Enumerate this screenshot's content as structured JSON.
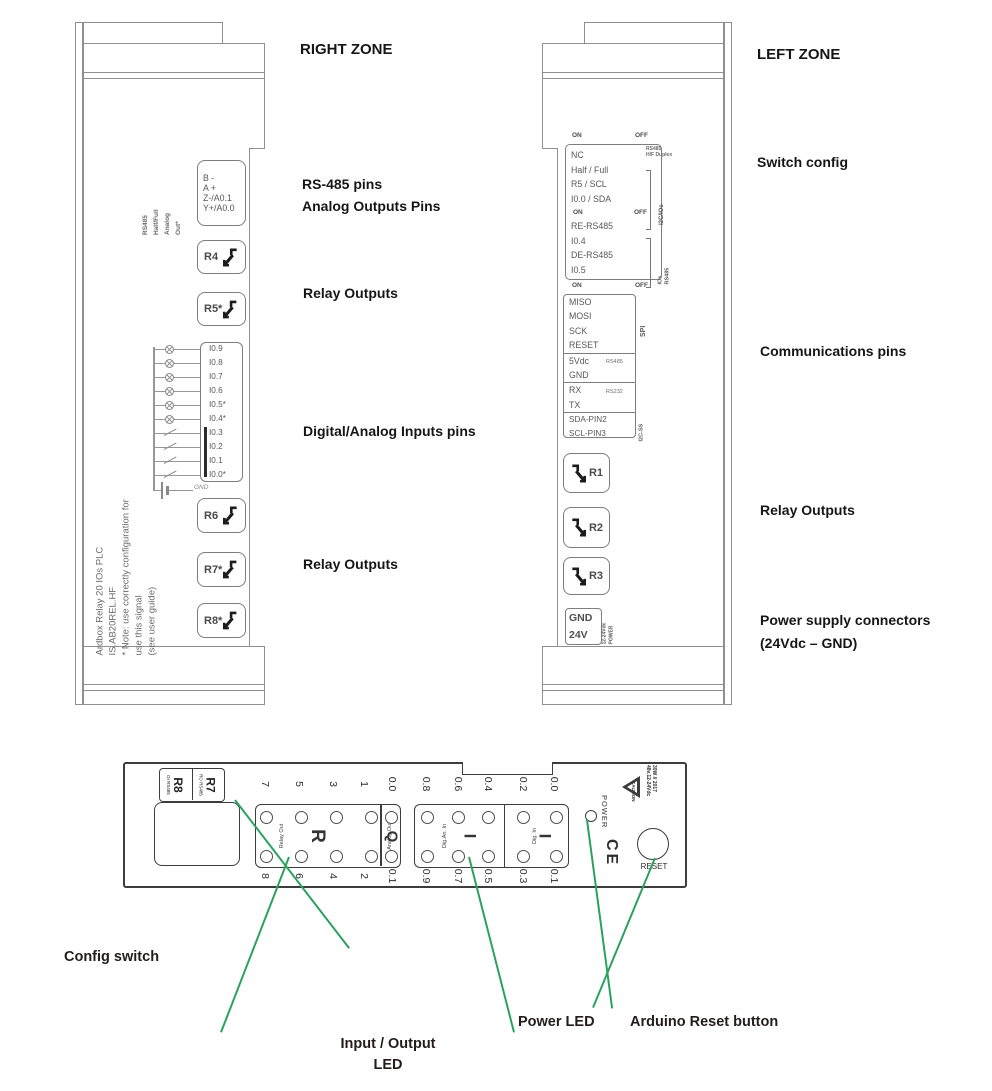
{
  "right_zone": {
    "title": "RIGHT ZONE",
    "labels": {
      "rs485": "RS-485 pins",
      "analog": "Analog Outputs Pins",
      "relay_top": "Relay Outputs",
      "inputs": "Digital/Analog Inputs pins",
      "relay_bottom": "Relay Outputs"
    },
    "device": {
      "side_text": [
        "RS485",
        "Half/Full",
        "Analog",
        "Out*"
      ],
      "conn": [
        "B -",
        "A +",
        "Z-/A0.1",
        "Y+/A0.0"
      ],
      "relays_top": [
        "R4",
        "R5*"
      ],
      "pins": [
        "I0.9",
        "I0.8",
        "I0.7",
        "I0.6",
        "I0.5*",
        "I0.4*",
        "I0.3",
        "I0.2",
        "I0.1",
        "I0.0*"
      ],
      "gnd": "GND",
      "relays_bottom": [
        "R6",
        "R7*",
        "R8*"
      ],
      "side_note": [
        "Ardbox Relay 20 IOs PLC",
        "IS.AB20REL.HF",
        "* Note: use correctly configuration for",
        "use this signal",
        "(see user guide)"
      ]
    }
  },
  "left_zone": {
    "title": "LEFT ZONE",
    "labels": {
      "switch": "Switch config",
      "comms": "Communications pins",
      "relay": "Relay Outputs",
      "power1": "Power supply connectors",
      "power2": "(24Vdc – GND)"
    },
    "device": {
      "on": "ON",
      "off": "OFF",
      "sw1": [
        "NC",
        "Half / Full",
        "R5 / SCL",
        "I0.0 / SDA"
      ],
      "sw2": [
        "RE-RS485",
        "I0.4",
        "DE-RS485",
        "I0.5"
      ],
      "tag_rs485": "RS485",
      "tag_hf": "H/F Duplex",
      "tag_i2c": "I2C/IOs",
      "tag_ios": "IOs",
      "tag_rs485b": "RS485",
      "spi": [
        "MISO",
        "MOSI",
        "SCK",
        "RESET"
      ],
      "spi_label": "SPI",
      "pwr": [
        "5Vdc",
        "GND"
      ],
      "pwr_tag": "RS485",
      "ser": [
        "RX",
        "TX"
      ],
      "ser_tag": "RS232",
      "i2c": [
        "SDA-PIN2",
        "SCL-PIN3"
      ],
      "i2c_label": "I2C-SS",
      "relays": [
        "R1",
        "R2",
        "R3"
      ],
      "supply": [
        "GND",
        "24V"
      ],
      "supply_rot": [
        "12-24Vdc",
        "POWER"
      ]
    }
  },
  "bottom": {
    "tag": {
      "s1_small1": "DI",
      "s1_small2": "RS485",
      "s1_big": "R8",
      "s2_small1": "RO",
      "s2_small2": "RS485",
      "s2_big": "R7"
    },
    "relay": {
      "label": "Relay Out",
      "big": "R",
      "top": [
        "7",
        "5",
        "3",
        "1"
      ],
      "bottom": [
        "8",
        "6",
        "4",
        "2"
      ]
    },
    "analog": {
      "label": "Analog Out",
      "big": "Q",
      "top": "0.0",
      "bottom": "0.1"
    },
    "digan": {
      "label": "Dig.An. In",
      "big": "I",
      "top": [
        "0.8",
        "0.6",
        "0.4"
      ],
      "bottom": [
        "0.9",
        "0.7",
        "0.5"
      ]
    },
    "dig": {
      "label": "Dig. In",
      "big": "I",
      "top": [
        "0.2",
        "0.0"
      ],
      "bottom": [
        "0.3",
        "0.1"
      ]
    },
    "power": "POWER",
    "ce": "CE",
    "reset": "RESET",
    "caution": {
      "title": "CAUTION",
      "l1": "48v.12-24Vdc",
      "l2": "30W // 2017"
    },
    "ann": {
      "config": "Config switch",
      "io1": "Input / Output",
      "io2": "LED",
      "power": "Power LED",
      "reset": "Arduino Reset button"
    }
  },
  "colors": {
    "annotation_green": "#2ba25c",
    "drawing_grey": "#8f8f8f",
    "label_black": "#161616"
  }
}
